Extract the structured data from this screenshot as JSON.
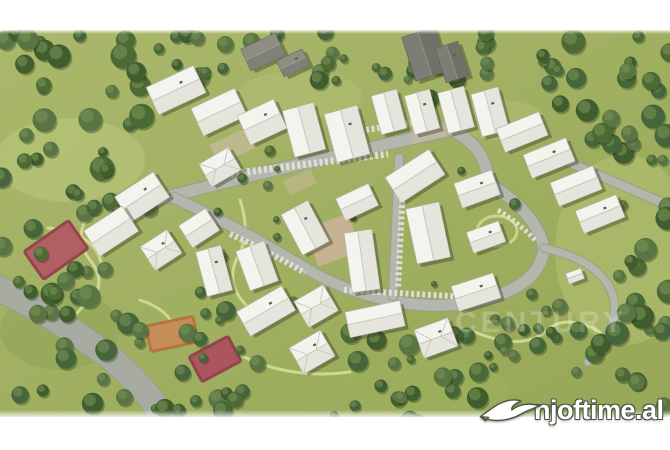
{
  "image": {
    "kind": "aerial-3d-render-site-plan",
    "description": "Aerial rendering of a residential complex with white apartment buildings, looping roads, trees and sports courts"
  },
  "watermarks": {
    "brand": {
      "text": "njoftime.al",
      "icon": "dove",
      "color": "#ffffff",
      "outline": "#4a5542"
    },
    "faint": {
      "text": "CENTURY",
      "opacity": 0.22
    }
  },
  "palette": {
    "margin": "#ffffff",
    "grass_light": "#aab86b",
    "grass_dark": "#96a757",
    "trees": [
      "#4b6a36",
      "#3f5d2d",
      "#587543",
      "#45663a"
    ],
    "tree_highlight": "#7c9456",
    "road": "#b4b7ae",
    "road_edge": "#999c92",
    "road_major": "#a8aba2",
    "parking": "#e0e0d8",
    "walk_path": "#d4dd97",
    "building_roof": "#f4f4ee",
    "building_shade": "#e2e2d9",
    "warehouse": "#7d7d75",
    "court_red": "#b25f63",
    "court_red_border": "#94464e",
    "court_orange": "#c78d58",
    "court_orange_border": "#b3763f",
    "plaza_tan": "#cbb39a"
  },
  "scene": {
    "clip": {
      "top": 30,
      "bottom": 417
    },
    "patches": [
      [
        70,
        160,
        75,
        42,
        "#bcc87e",
        0.55
      ],
      [
        300,
        95,
        62,
        24,
        "#b8c478",
        0.45
      ],
      [
        625,
        250,
        70,
        95,
        "#b4c173",
        0.55
      ],
      [
        500,
        120,
        45,
        20,
        "#b8c478",
        0.4
      ],
      [
        60,
        330,
        60,
        40,
        "#8da254",
        0.5
      ],
      [
        420,
        390,
        90,
        30,
        "#9cb05e",
        0.6
      ]
    ],
    "walk_paths": [
      {
        "d": "M95,205 Q70,235 90,260 Q110,285 85,305 Q60,325 85,345",
        "w": 3
      },
      {
        "d": "M140,300 Q170,310 175,330",
        "w": 3
      },
      {
        "d": "M240,200 Q252,235 236,260 Q226,285 246,305",
        "w": 3
      },
      {
        "d": "M48,228 Q98,233 102,268",
        "w": 3
      },
      {
        "d": "M240,355 Q290,380 350,372",
        "w": 3
      },
      {
        "d": "M470,330 Q520,352 545,332 Q565,312 600,332",
        "w": 3
      }
    ],
    "path_ring": {
      "cx": 497,
      "cy": 231,
      "rx": 20,
      "ry": 15
    },
    "roads": [
      {
        "d": "M148,202 Q300,162 452,130",
        "w": 11
      },
      {
        "d": "M452,130 Q487,147 488,183 Q536,212 544,248 Q540,289 472,302 Q436,309 392,301",
        "w": 11
      },
      {
        "d": "M174,198 Q240,228 312,272 Q352,294 392,301",
        "w": 10
      },
      {
        "d": "M399,158 L393,296",
        "w": 8
      },
      {
        "d": "M545,152 Q610,180 672,207",
        "w": 8
      },
      {
        "d": "M544,248 Q606,262 614,300 Q618,332 588,362",
        "w": 7
      },
      {
        "d": "M-6,286 Q58,318 108,356 Q150,390 163,420",
        "w": 24,
        "major": true
      }
    ],
    "parking_rows": [
      {
        "d": "M214,176 Q300,165 388,154",
        "w": 7
      },
      {
        "d": "M404,166 L398,288",
        "w": 6
      },
      {
        "d": "M344,290 L468,297",
        "w": 6
      },
      {
        "d": "M230,234 Q270,252 305,273",
        "w": 6
      },
      {
        "d": "M366,130 L428,120",
        "w": 6
      },
      {
        "d": "M498,210 Q520,224 535,240",
        "w": 5
      }
    ],
    "lots": [
      [
        333,
        240,
        46,
        40,
        -20,
        "#cbb39a",
        0.85
      ],
      [
        233,
        146,
        42,
        22,
        -25,
        "#c9bc9e",
        0.7
      ],
      [
        300,
        182,
        30,
        16,
        -25,
        "#c4b795",
        0.6
      ],
      [
        440,
        130,
        58,
        14,
        -15,
        "#c7ba9c",
        0.55
      ]
    ],
    "courts": [
      [
        56,
        250,
        54,
        34,
        -35,
        "#b25f63",
        "#94464e"
      ],
      [
        172,
        334,
        48,
        26,
        -12,
        "#c78d58",
        "#b3763f"
      ],
      [
        215,
        359,
        44,
        28,
        -28,
        "#aa565c",
        "#93444c"
      ]
    ],
    "tree_zones": [
      [
        0,
        30,
        150,
        200,
        36,
        5,
        13
      ],
      [
        0,
        230,
        130,
        190,
        26,
        5,
        12
      ],
      [
        130,
        300,
        170,
        115,
        20,
        4,
        10
      ],
      [
        150,
        30,
        270,
        55,
        22,
        4,
        10
      ],
      [
        405,
        30,
        160,
        70,
        16,
        4,
        10
      ],
      [
        555,
        30,
        115,
        130,
        22,
        5,
        12
      ],
      [
        590,
        160,
        80,
        260,
        24,
        5,
        12
      ],
      [
        300,
        330,
        290,
        90,
        26,
        4,
        11
      ],
      [
        200,
        145,
        340,
        175,
        20,
        3,
        6
      ],
      [
        440,
        300,
        150,
        70,
        14,
        4,
        9
      ]
    ],
    "buildings": [
      [
        176,
        90,
        52,
        30,
        -25,
        0
      ],
      [
        219,
        112,
        48,
        30,
        -25,
        0
      ],
      [
        262,
        122,
        40,
        32,
        -25,
        0
      ],
      [
        304,
        130,
        32,
        48,
        -15,
        0
      ],
      [
        347,
        134,
        34,
        50,
        -15,
        0
      ],
      [
        389,
        112,
        26,
        40,
        -15,
        0
      ],
      [
        422,
        112,
        26,
        40,
        -15,
        0
      ],
      [
        456,
        110,
        27,
        42,
        -15,
        0
      ],
      [
        490,
        112,
        28,
        44,
        -15,
        0
      ],
      [
        522,
        132,
        46,
        25,
        -22,
        0
      ],
      [
        549,
        158,
        46,
        25,
        -22,
        0
      ],
      [
        576,
        186,
        46,
        25,
        -22,
        0
      ],
      [
        600,
        214,
        44,
        24,
        -22,
        0
      ],
      [
        425,
        54,
        34,
        46,
        -18,
        2
      ],
      [
        452,
        62,
        24,
        36,
        -18,
        2
      ],
      [
        263,
        52,
        38,
        24,
        -25,
        3
      ],
      [
        293,
        63,
        28,
        18,
        -25,
        3
      ],
      [
        415,
        176,
        52,
        30,
        -33,
        0
      ],
      [
        477,
        189,
        40,
        26,
        -20,
        0
      ],
      [
        357,
        202,
        36,
        24,
        -25,
        0
      ],
      [
        305,
        228,
        30,
        46,
        -28,
        0
      ],
      [
        428,
        233,
        34,
        56,
        -12,
        0
      ],
      [
        486,
        237,
        34,
        22,
        -20,
        0
      ],
      [
        362,
        261,
        28,
        60,
        -8,
        0
      ],
      [
        476,
        292,
        44,
        26,
        -18,
        0
      ],
      [
        220,
        167,
        34,
        26,
        -30,
        1
      ],
      [
        142,
        197,
        46,
        30,
        -33,
        0
      ],
      [
        111,
        231,
        46,
        30,
        -33,
        0
      ],
      [
        161,
        250,
        32,
        28,
        -33,
        1
      ],
      [
        199,
        228,
        32,
        26,
        -33,
        0
      ],
      [
        214,
        271,
        26,
        46,
        -15,
        0
      ],
      [
        257,
        266,
        30,
        42,
        -20,
        0
      ],
      [
        266,
        311,
        52,
        28,
        -30,
        0
      ],
      [
        316,
        306,
        34,
        30,
        -30,
        1
      ],
      [
        312,
        352,
        36,
        30,
        -30,
        1
      ],
      [
        375,
        319,
        56,
        26,
        -12,
        0
      ],
      [
        436,
        338,
        36,
        30,
        -20,
        1
      ],
      [
        575,
        276,
        16,
        11,
        -20,
        0
      ]
    ],
    "faint_watermark_pos": {
      "x": 455,
      "y": 332,
      "size": 30
    }
  }
}
